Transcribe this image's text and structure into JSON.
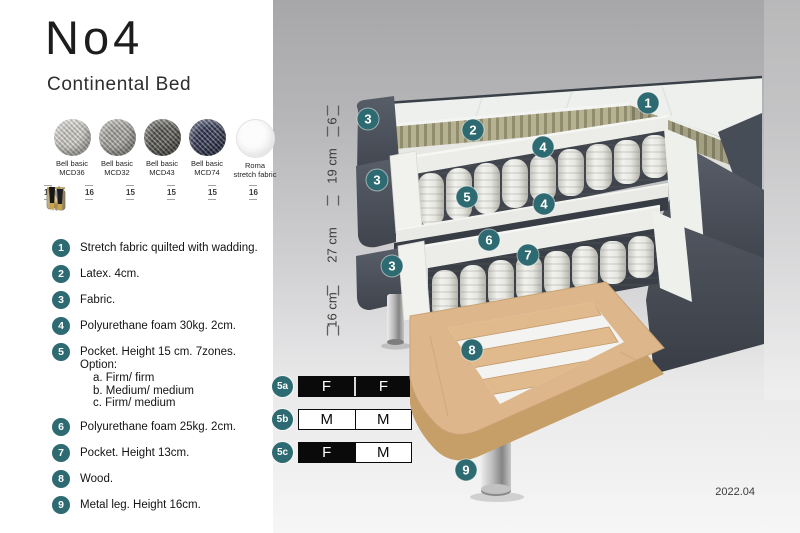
{
  "title": "No4",
  "subtitle": "Continental Bed",
  "swatches": [
    {
      "line1": "Bell basic",
      "line2": "MCD36"
    },
    {
      "line1": "Bell basic",
      "line2": "MCD32"
    },
    {
      "line1": "Bell basic",
      "line2": "MCD43"
    },
    {
      "line1": "Bell basic",
      "line2": "MCD74"
    },
    {
      "line1": "Roma",
      "line2": "stretch fabric"
    }
  ],
  "legs": [
    {
      "size": "16",
      "icon": "cylinder-pair-chrome"
    },
    {
      "size": "16",
      "icon": "cylinder-pair-bronze"
    },
    {
      "size": "15",
      "icon": "twisted-gold"
    },
    {
      "size": "15",
      "icon": "twisted-silver"
    },
    {
      "size": "15",
      "icon": "hairpin-gold"
    },
    {
      "size": "16",
      "icon": "tapered-black-gold"
    }
  ],
  "features": [
    {
      "num": "1",
      "text": "Stretch fabric quilted with wadding."
    },
    {
      "num": "2",
      "text": "Latex. 4cm."
    },
    {
      "num": "3",
      "text": "Fabric."
    },
    {
      "num": "4",
      "text": "Polyurethane foam 30kg. 2cm."
    },
    {
      "num": "5",
      "text": "Pocket. Height 15 cm. 7zones. Option:",
      "options": [
        "a. Firm/ firm",
        "b. Medium/ medium",
        "c. Firm/ medium"
      ]
    },
    {
      "num": "6",
      "text": "Polyurethane foam 25kg. 2cm."
    },
    {
      "num": "7",
      "text": "Pocket. Height 13cm."
    },
    {
      "num": "8",
      "text": "Wood."
    },
    {
      "num": "9",
      "text": "Metal leg. Height 16cm."
    }
  ],
  "firmness": [
    {
      "id": "5a",
      "left": "F",
      "right": "F"
    },
    {
      "id": "5b",
      "left": "M",
      "right": "M"
    },
    {
      "id": "5c",
      "left": "F",
      "right": "M"
    }
  ],
  "diagram": {
    "dimensions": [
      {
        "label": "6"
      },
      {
        "label": "19 cm"
      },
      {
        "label": "27 cm"
      },
      {
        "label": "16 cm"
      }
    ],
    "callouts": [
      {
        "n": "1"
      },
      {
        "n": "2"
      },
      {
        "n": "3"
      },
      {
        "n": "4"
      },
      {
        "n": "3"
      },
      {
        "n": "5"
      },
      {
        "n": "4"
      },
      {
        "n": "6"
      },
      {
        "n": "7"
      },
      {
        "n": "3"
      },
      {
        "n": "8"
      },
      {
        "n": "9"
      }
    ]
  },
  "footer": {
    "version": "2022.04"
  },
  "colors": {
    "teal": "#2d6a71",
    "fabric_dark": "#4a505a",
    "latex": "#b6b191",
    "wood": "#dcb68a",
    "chrome": "#c9c9c9"
  }
}
